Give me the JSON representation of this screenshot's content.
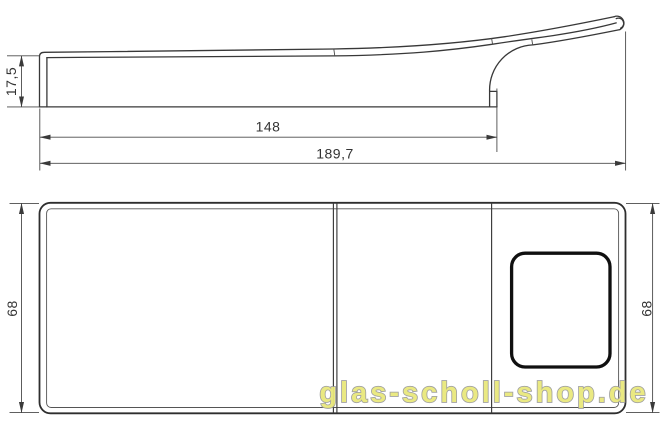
{
  "drawing": {
    "kind": "technical-drawing-two-views",
    "line_color": "#383838",
    "dim_color": "#4a4a4a",
    "side_view": {
      "dims": {
        "height": "17,5",
        "plate_length": "148",
        "total_length": "189,7"
      }
    },
    "plan_view": {
      "dims": {
        "width_left": "68",
        "width_right": "68"
      }
    },
    "watermark": {
      "text": "glas-scholl-shop.de",
      "fill": "#e9e87c",
      "outline": "#9c9c9c"
    }
  }
}
